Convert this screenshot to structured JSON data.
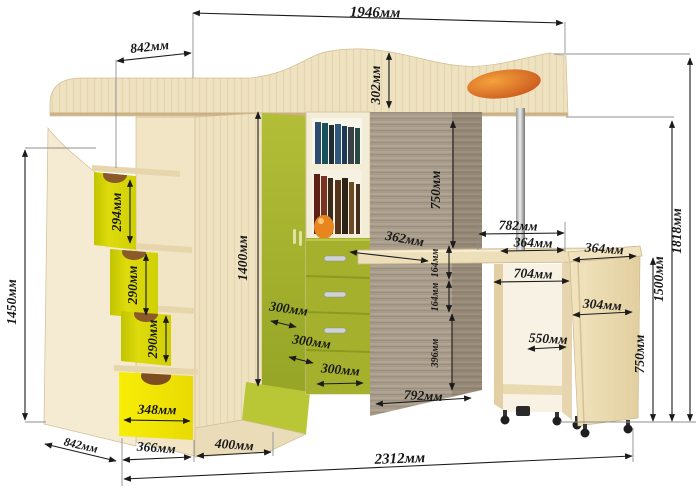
{
  "diagram": {
    "type": "furniture-dimension-diagram",
    "unit": "мм",
    "dims": {
      "d1946": "1946мм",
      "d842_top": "842мм",
      "d302": "302мм",
      "d1450": "1450мм",
      "d294": "294мм",
      "d290_a": "290мм",
      "d290_b": "290мм",
      "d348": "348мм",
      "d1400": "1400мм",
      "d750_mid": "750мм",
      "d362": "362мм",
      "d164_a": "164мм",
      "d164_b": "164мм",
      "d396": "396мм",
      "d300_a": "300мм",
      "d300_b": "300мм",
      "d300_c": "300мм",
      "d792": "792мм",
      "d782": "782мм",
      "d364_a": "364мм",
      "d704": "704мм",
      "d364_b": "364мм",
      "d304": "304мм",
      "d550": "550мм",
      "d750_right": "750мм",
      "d1500": "1500мм",
      "d1818": "1818мм",
      "d842_bottom": "842мм",
      "d366": "366мм",
      "d400": "400мм",
      "d2312": "2312мм"
    },
    "colors": {
      "wood_light": "#efe2c0",
      "wood_mid": "#e6d3a8",
      "panel_taupe": "#a79a89",
      "green_olive": "#a8b42e",
      "green_bright": "#b9c636",
      "yellow_step": "#d6d408",
      "yellow_drawer": "#f2e70a",
      "accent_orange": "#e8851e",
      "dim_line": "#1b1b1b"
    }
  }
}
